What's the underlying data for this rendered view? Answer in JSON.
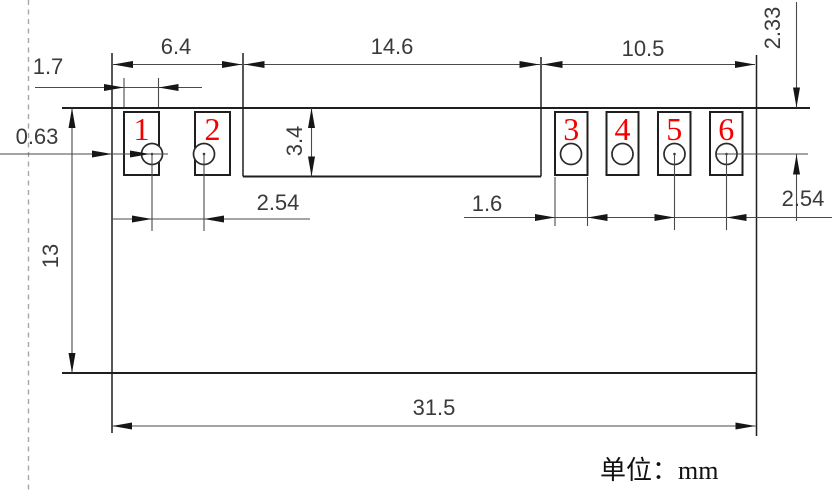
{
  "drawing": {
    "type": "mechanical-dimension-drawing",
    "unit_label": "单位：mm",
    "pads": [
      "1",
      "2",
      "3",
      "4",
      "5",
      "6"
    ],
    "dims": {
      "left_section_width": "6.4",
      "middle_section_width": "14.6",
      "right_section_width": "10.5",
      "pad12_width": "1.7",
      "edge_to_pad1_gap": "0.63",
      "top_to_hole_center": "2.33",
      "recess_depth": "3.4",
      "body_height": "13",
      "hole_pitch_left": "2.54",
      "pad36_width": "1.6",
      "hole_pitch_right": "2.54",
      "body_width": "31.5"
    },
    "colors": {
      "outline": "#1f1f1f",
      "dimension_line": "#4a4a4a",
      "pad_number": "#f40000",
      "construction_line": "#a6a6a6"
    }
  }
}
